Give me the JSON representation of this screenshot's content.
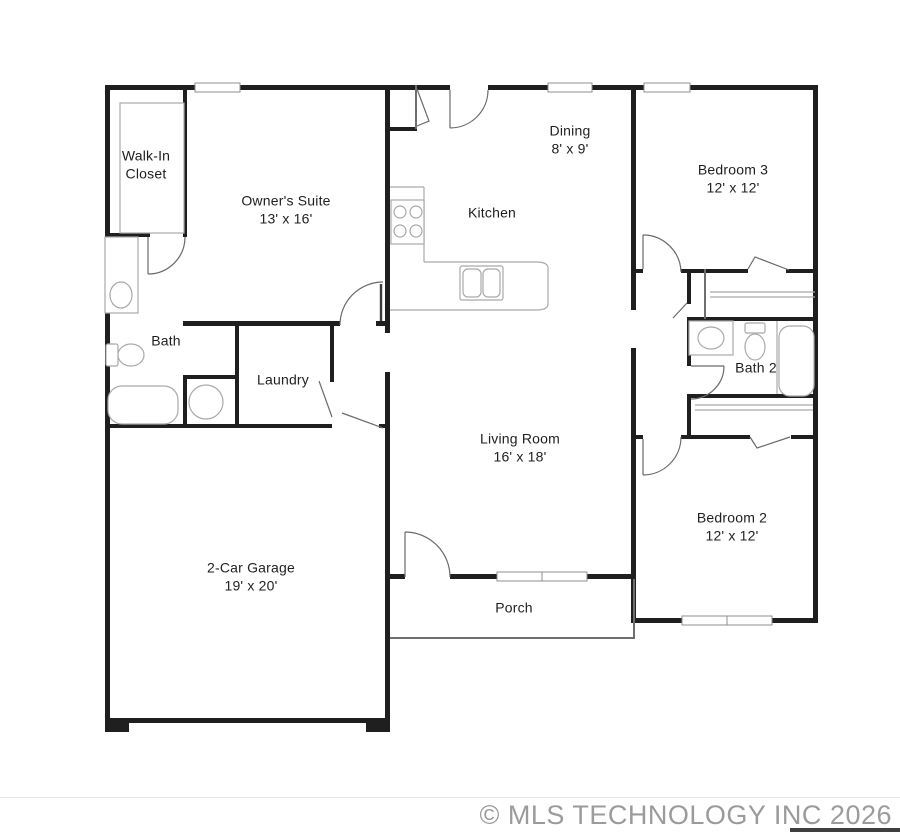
{
  "colors": {
    "bg": "#ffffff",
    "wall": "#1f1f1f",
    "thin": "#6e6e6e",
    "fixture": "#a9a9a9",
    "door": "#6a6a6a",
    "windowframe": "#8f8f8f",
    "label": "#1e1e1e",
    "watermark": "#9b9b9b",
    "divider": "#e6e6e6",
    "corner": "#3f3f3f"
  },
  "floorplan": {
    "title": "Single story floor plan",
    "rooms": {
      "walk_in_closet": {
        "name": "Walk-In Closet",
        "dimensions": "",
        "line1": "Walk-In",
        "line2": "Closet"
      },
      "owners_suite": {
        "name": "Owner's Suite",
        "dimensions": "13' x 16'",
        "line1": "Owner's Suite",
        "line2": "13' x 16'"
      },
      "dining": {
        "name": "Dining",
        "dimensions": "8' x 9'",
        "line1": "Dining",
        "line2": "8' x 9'"
      },
      "kitchen": {
        "name": "Kitchen",
        "dimensions": "",
        "line1": "Kitchen",
        "line2": ""
      },
      "bedroom3": {
        "name": "Bedroom 3",
        "dimensions": "12' x 12'",
        "line1": "Bedroom 3",
        "line2": "12' x 12'"
      },
      "bath": {
        "name": "Bath",
        "dimensions": "",
        "line1": "Bath",
        "line2": ""
      },
      "laundry": {
        "name": "Laundry",
        "dimensions": "",
        "line1": "Laundry",
        "line2": ""
      },
      "bath2": {
        "name": "Bath 2",
        "dimensions": "",
        "line1": "Bath 2",
        "line2": ""
      },
      "living_room": {
        "name": "Living Room",
        "dimensions": "16' x 18'",
        "line1": "Living Room",
        "line2": "16' x 18'"
      },
      "bedroom2": {
        "name": "Bedroom 2",
        "dimensions": "12' x 12'",
        "line1": "Bedroom 2",
        "line2": "12' x 12'"
      },
      "garage": {
        "name": "2-Car Garage",
        "dimensions": "19' x 20'",
        "line1": "2-Car Garage",
        "line2": "19' x 20'"
      },
      "porch": {
        "name": "Porch",
        "dimensions": "",
        "line1": "Porch",
        "line2": ""
      }
    },
    "fixtures": {
      "kitchen": [
        "stove-icon",
        "kitchen-island",
        "kitchen-double-sink-icon"
      ],
      "bath": [
        "vanity-sink-icon",
        "toilet-icon",
        "bathtub-icon"
      ],
      "bath2": [
        "vanity-sink-icon",
        "toilet-icon",
        "bathtub-icon"
      ],
      "utility": [
        "water-heater-icon"
      ],
      "closets": [
        "closet-rod",
        "closet-shelf"
      ]
    }
  },
  "watermark": {
    "copyright": "© MLS TECHNOLOGY INC 2026"
  }
}
